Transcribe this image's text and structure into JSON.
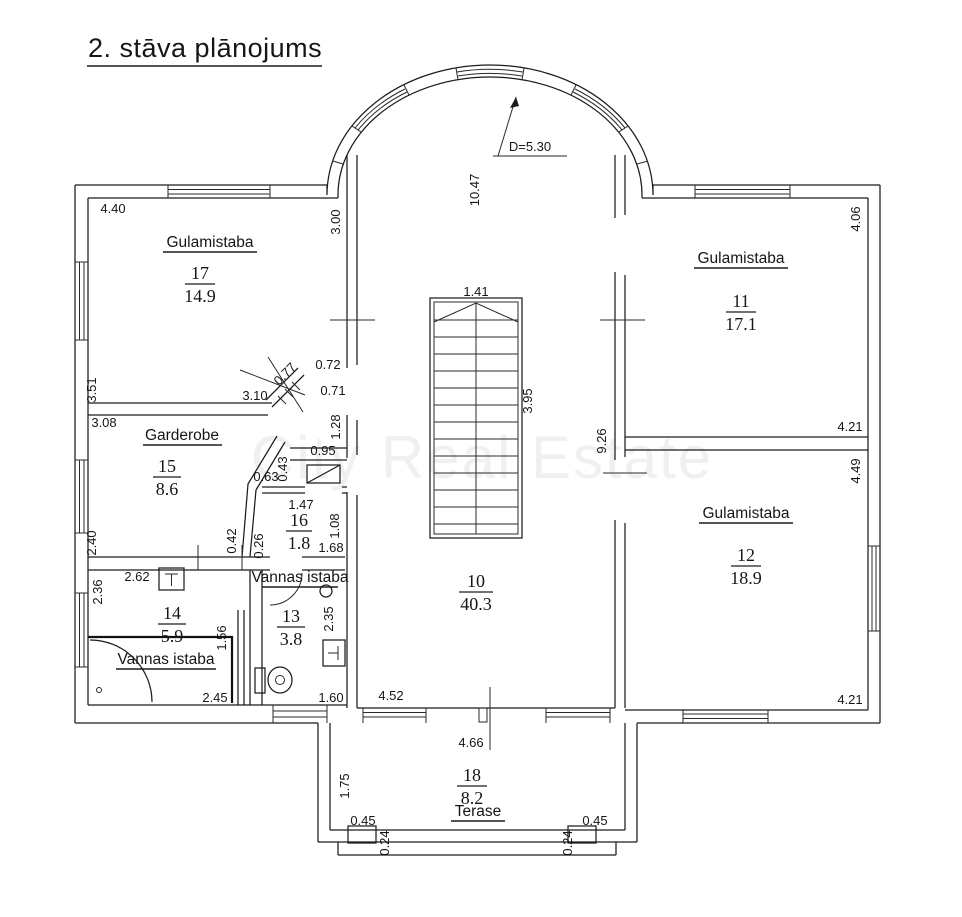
{
  "title": "2. stāva plānojums",
  "watermark": "City Real Estate",
  "rooms": {
    "r17": {
      "name": "Gulamistaba",
      "number": "17",
      "area": "14.9"
    },
    "r15": {
      "name": "Garderobe",
      "number": "15",
      "area": "8.6"
    },
    "r16": {
      "number": "16",
      "area": "1.8"
    },
    "r14": {
      "name": "Vannas istaba",
      "number": "14",
      "area": "5.9"
    },
    "r13": {
      "name": "Vannas istaba",
      "number": "13",
      "area": "3.8"
    },
    "r10": {
      "number": "10",
      "area": "40.3"
    },
    "r11": {
      "name": "Gulamistaba",
      "number": "11",
      "area": "17.1"
    },
    "r12": {
      "name": "Gulamistaba",
      "number": "12",
      "area": "18.9"
    },
    "r18": {
      "name": "Terase",
      "number": "18",
      "area": "8.2"
    }
  },
  "dimensions": {
    "r17_top": "4.40",
    "r17_right": "3.00",
    "r17_left": "3.51",
    "r17_bottom": "3.10",
    "r17_door": "0.77",
    "nook_a": "0.72",
    "nook_b": "0.71",
    "hall_wall": "1.28",
    "r15_top": "3.08",
    "vest_top": "0.95",
    "vest_side": "0.43",
    "vest_slant": "0.63",
    "r15_left": "2.40",
    "r16_slant": "0.42",
    "r16_left": "0.26",
    "r16_top": "1.47",
    "r16_right": "1.08",
    "r16_bottom": "1.68",
    "r14_top": "2.62",
    "r14_left": "2.36",
    "r14_right": "1.56",
    "r14_bottom": "2.45",
    "r13_right": "2.35",
    "r13_bottom": "1.60",
    "hall_len": "10.47",
    "arch_d": "D=5.30",
    "stair_w": "1.41",
    "stair_len": "3.95",
    "hall_right": "9.26",
    "r11_right": "4.06",
    "r11_bottom": "4.21",
    "r12_right": "4.49",
    "r12_bottom": "4.21",
    "hall_ba": "4.52",
    "hall_bb": "4.66",
    "ter_left": "1.75",
    "ter_l45": "0.45",
    "ter_l24": "0.24",
    "ter_r24": "0.24",
    "ter_r45": "0.45"
  }
}
